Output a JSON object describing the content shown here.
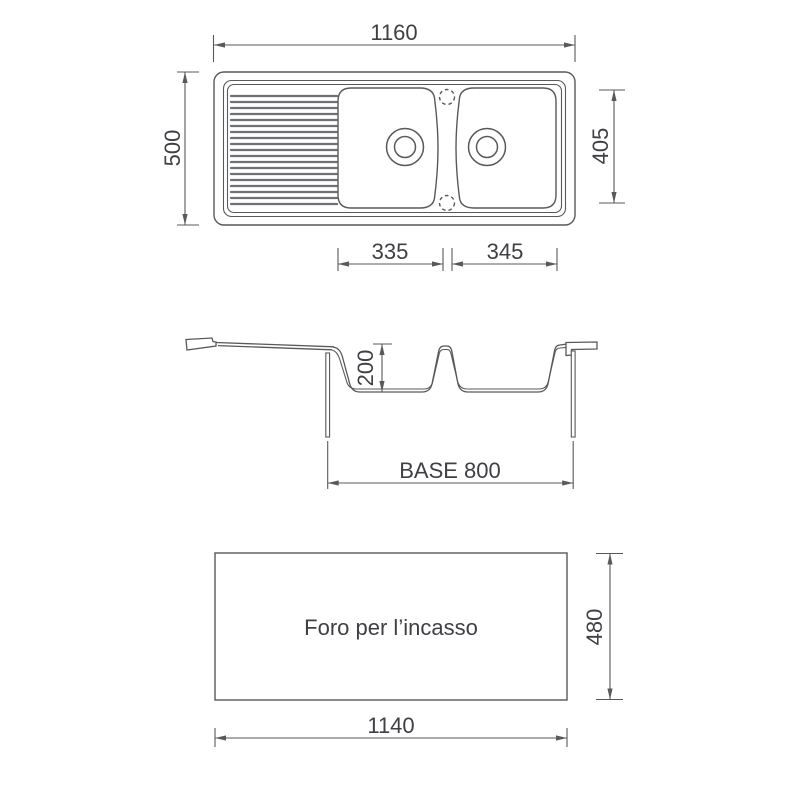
{
  "drawing": {
    "colors": {
      "background": "#ffffff",
      "line": "#58595b",
      "rib": "#707174",
      "text": "#3f4044"
    },
    "top_view": {
      "overall_width_mm": "1160",
      "overall_depth_mm": "500",
      "bowls_span_mm": "405",
      "left_bowl_width_mm": "335",
      "right_bowl_width_mm": "345"
    },
    "section_view": {
      "bowl_depth_mm": "200",
      "base_cabinet_label": "BASE 800"
    },
    "cutout_view": {
      "caption": "Foro per l’incasso",
      "width_mm": "1140",
      "height_mm": "480"
    }
  }
}
